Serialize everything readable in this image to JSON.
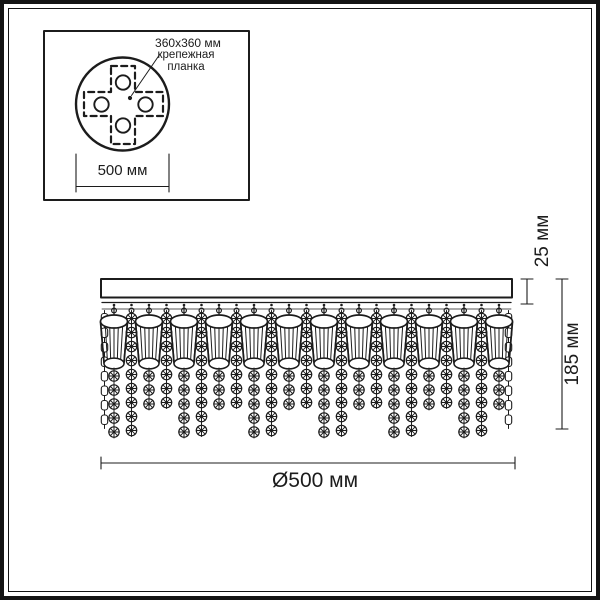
{
  "inset": {
    "plate_size_label": "360x360 мм",
    "plate_name_label": "крепежная планка",
    "base_width": "500 мм"
  },
  "dimensions": {
    "band_height": "25 мм",
    "total_height": "185 мм",
    "diameter": "Ø500 мм"
  },
  "colors": {
    "ink": "#1c1c1c",
    "paper": "#ffffff"
  }
}
